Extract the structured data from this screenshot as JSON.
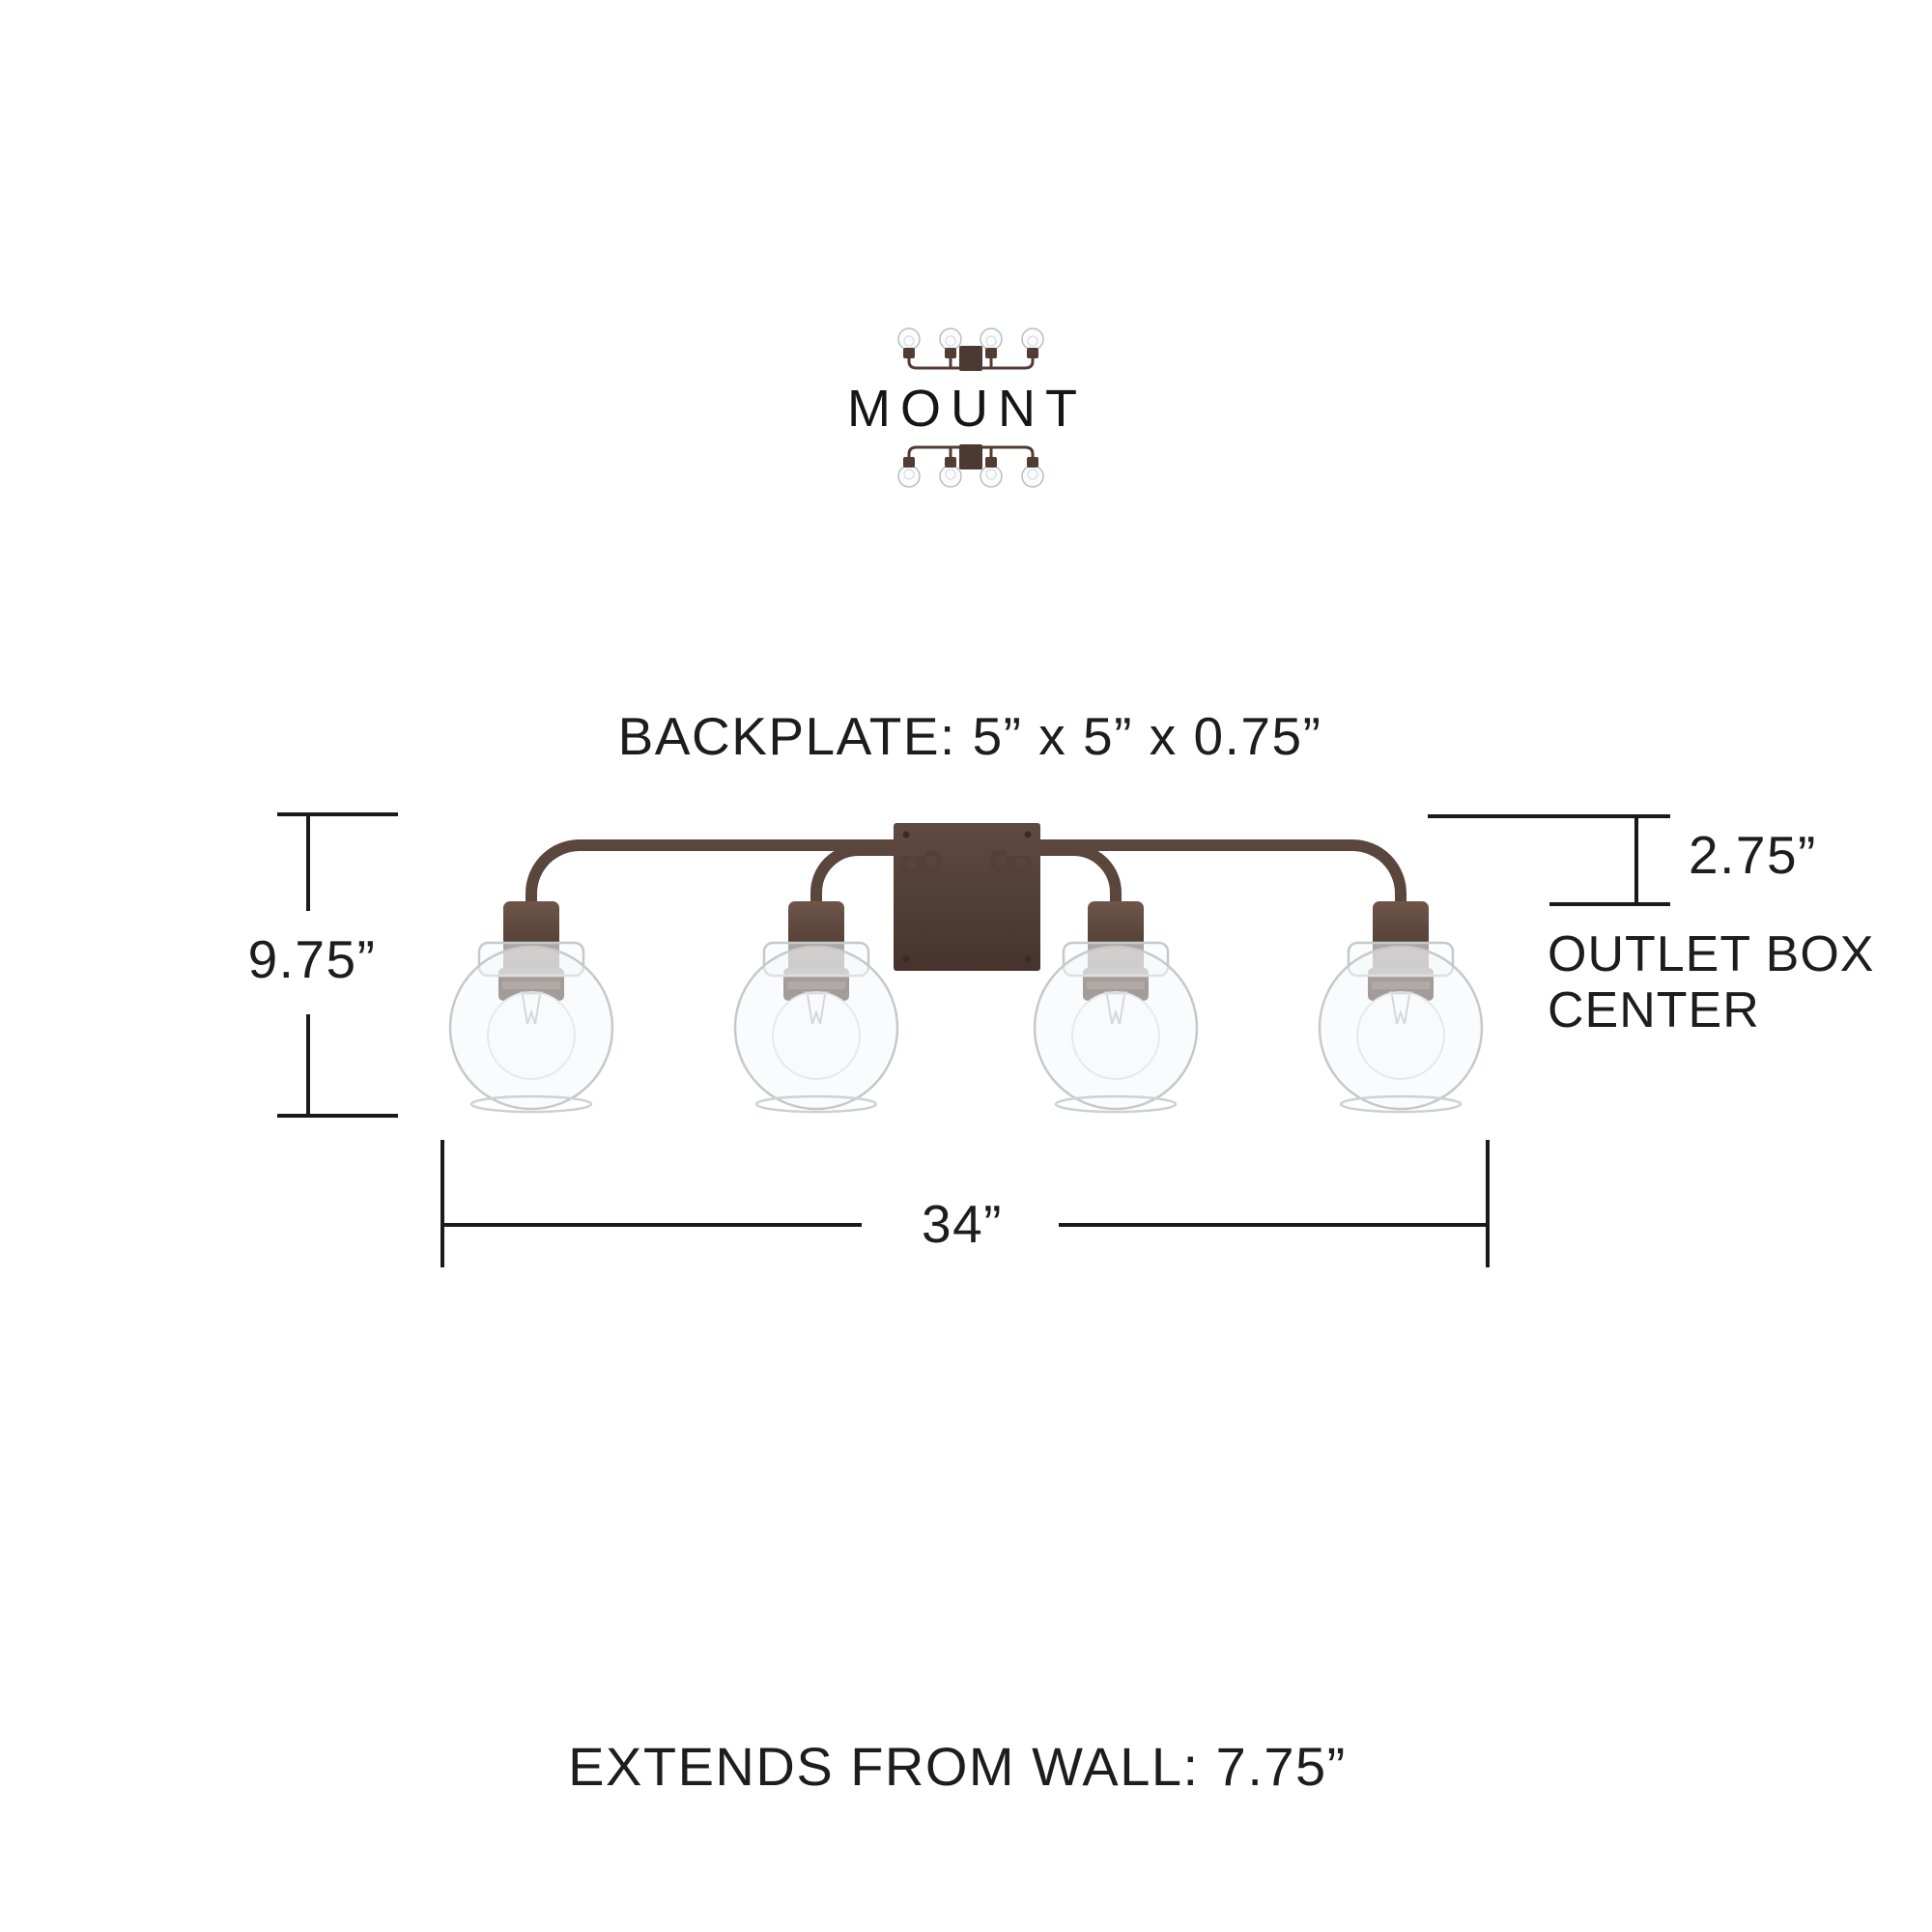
{
  "mount": {
    "label": "MOUNT",
    "icons": [
      "vanity-up-orientation",
      "vanity-down-orientation"
    ]
  },
  "specs": {
    "backplate": "BACKPLATE: 5” x 5” x 0.75”",
    "height": "9.75”",
    "outlet_offset": "2.75”",
    "outlet_label_line1": "OUTLET BOX",
    "outlet_label_line2": "CENTER",
    "width": "34”",
    "extends": "EXTENDS FROM WALL: 7.75”"
  },
  "fixture": {
    "lights": 4,
    "style": "4-light vanity bar with clear glass globes and bronze finish"
  },
  "colors": {
    "background": "#ffffff",
    "text": "#1d1d1d",
    "dimension_line": "#1a1a1a",
    "bronze_dark": "#46342c",
    "bronze_mid": "#5a463d",
    "bronze_light": "#6e564a",
    "glass_outline": "#c6c9ca"
  }
}
